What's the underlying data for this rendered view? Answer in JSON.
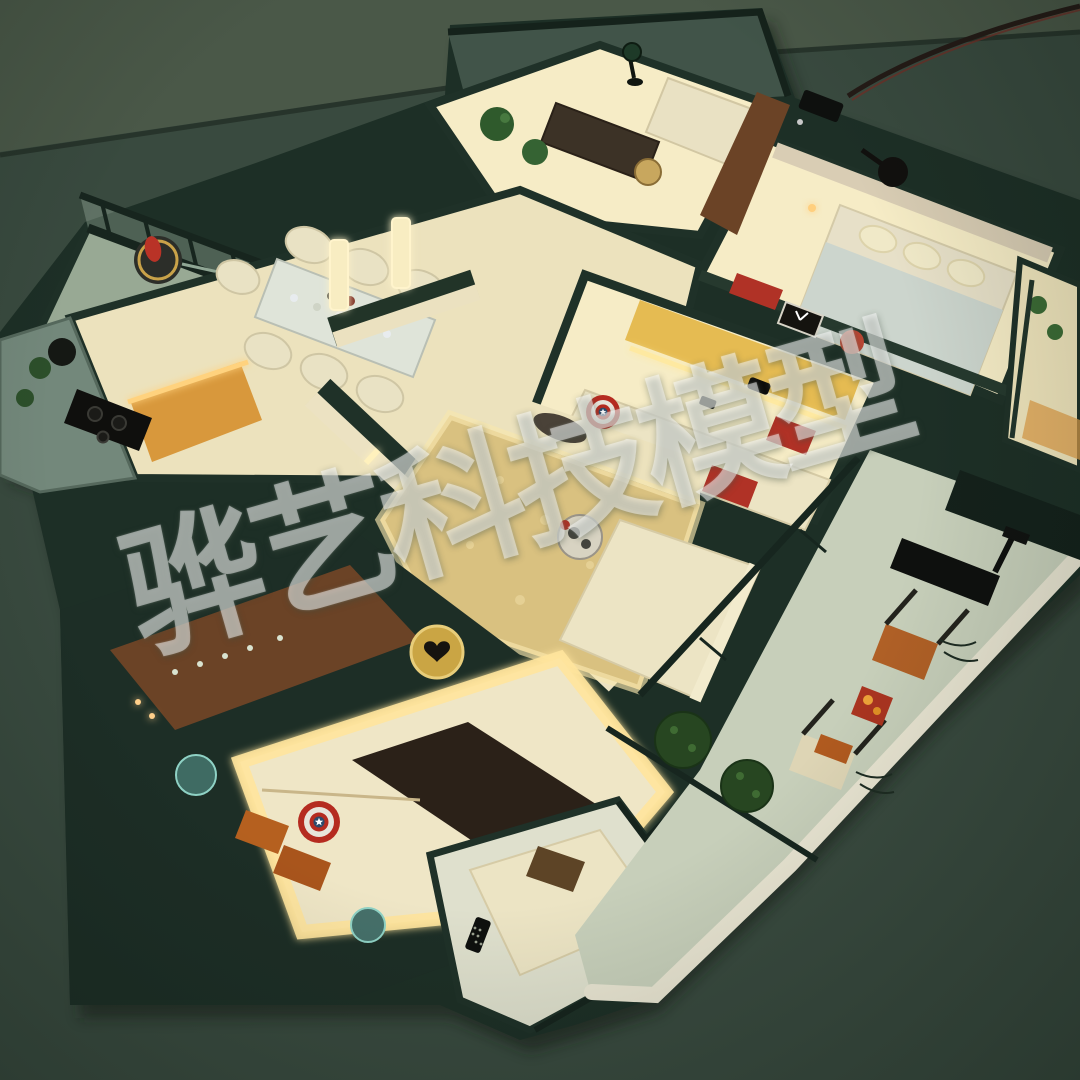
{
  "photo": {
    "subject": "illuminated miniature apartment model (dollhouse scale) photographed from above on a dark green table",
    "lighting": "warm LED strip lighting inside rooms, dark ambient surroundings"
  },
  "watermark": {
    "text": "骅艺科技模型",
    "rotation_deg": -16,
    "color": "rgba(255,255,255,0.46)"
  },
  "colors": {
    "bg": "#394a3f",
    "bg_top": "#4a5848",
    "seam": "#243028",
    "wall_dark": "#1d2f26",
    "wall_mid": "#2b4035",
    "floor": "#ece2bd",
    "floor_bright": "#f6ecc6",
    "glow": "#ffe9a8",
    "glass": "#93a896",
    "counter": "#73887b",
    "wood": "#6b4326",
    "orange_cabinet": "#d8983c",
    "terrace_floor": "#c7cfba",
    "parapet": "#e9e5d2",
    "topiary": "#274621",
    "cushion_orange": "#b06026",
    "accent_red": "#b03226",
    "duvet": "#ccd5cd",
    "rug_gold": "#d9c180",
    "dark_obj": "#0e100e",
    "cream_sofa": "#ece4c4",
    "runner_dark": "#2b2118",
    "marble": "#dfe4d9",
    "shield_red": "#b52b20",
    "shield_white": "#e8e4da",
    "shield_blue": "#2c4a6b",
    "mirror_gold": "#caa544",
    "table_red": "#aa3420",
    "drink_orange": "#eda339"
  },
  "scene": {
    "rooms": [
      {
        "id": "open-kitchen",
        "label": "open kitchen with black cooktop, kettle and orange under-lit cabinets"
      },
      {
        "id": "dining-area",
        "label": "marble dining table set with cream chairs, glasses and decor"
      },
      {
        "id": "study",
        "label": "glass-walled study with dark desk, lamp and cream sofa"
      },
      {
        "id": "front-balcony",
        "label": "glass-railed balcony with gold tray and red figurine"
      },
      {
        "id": "bedroom-one",
        "label": "bedroom with pale duvet, cream pillows and ceiling fan"
      },
      {
        "id": "media-lounge",
        "label": "lounge with backlit yellow shelf, red box, clock and red vase"
      },
      {
        "id": "living-room",
        "label": "living room with gold shag rug, sectional sofa and shield cushion"
      },
      {
        "id": "master-bedroom",
        "label": "master bedroom with glowing bed surround, orange pillows and shield cushion"
      },
      {
        "id": "rear-balcony",
        "label": "small balcony with daybed, brown pillow and remote control"
      },
      {
        "id": "terrace",
        "label": "wrap-around terrace with treadmill, loungers, red side table and topiary balls"
      }
    ],
    "objects": {
      "shield_cushions": 2,
      "topiary_balls": 2,
      "treadmill": 1,
      "heart_mirror": 1,
      "remote_control": 1,
      "power_cable": 1
    }
  }
}
